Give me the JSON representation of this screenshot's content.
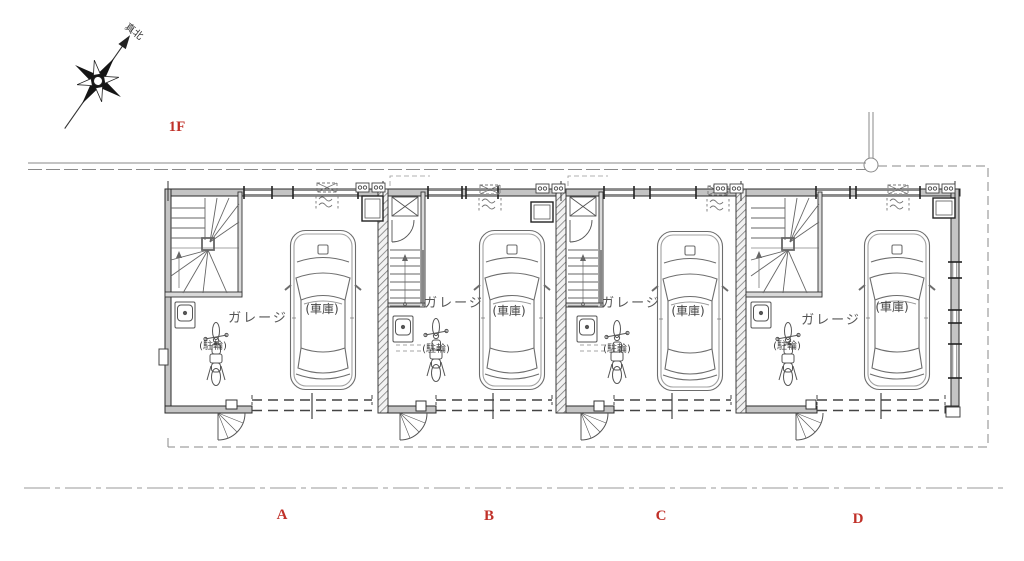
{
  "drawing": {
    "floor": {
      "label": "1F"
    },
    "compass": {
      "label": "真北"
    },
    "units": [
      {
        "label": "A",
        "garage_label": "ガレージ",
        "car_label": "(車庫)",
        "bike_label": "(駐輪)"
      },
      {
        "label": "B",
        "garage_label": "ガレージ",
        "car_label": "(車庫)",
        "bike_label": "(駐輪)"
      },
      {
        "label": "C",
        "garage_label": "ガレージ",
        "car_label": "(車庫)",
        "bike_label": "(駐輪)"
      },
      {
        "label": "D",
        "garage_label": "ガレージ",
        "car_label": "(車庫)",
        "bike_label": "(駐輪)"
      }
    ],
    "colors": {
      "label_red": "#c03028",
      "line_gray": "#666666",
      "wall_dark": "#2a2a2a"
    }
  }
}
